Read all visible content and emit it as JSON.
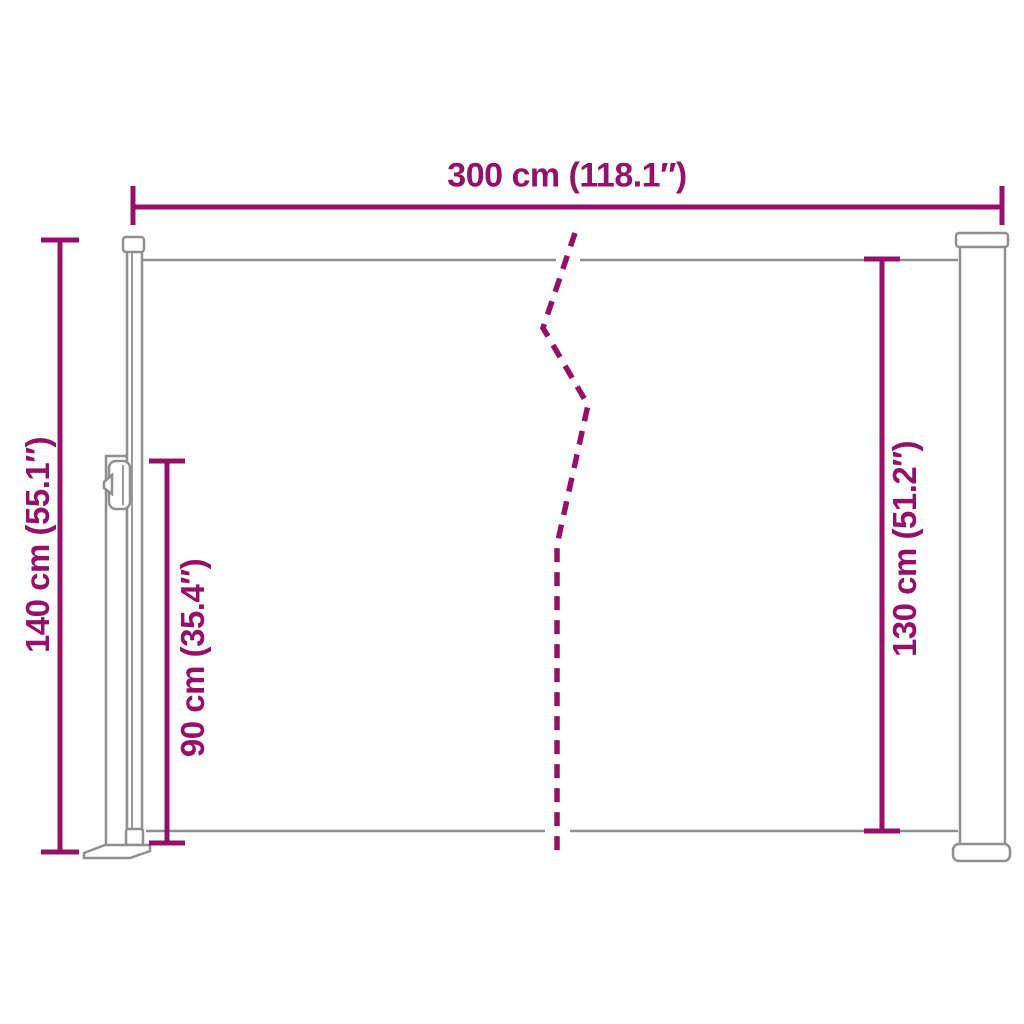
{
  "colors": {
    "accent": "#941069",
    "drawing_gray": "#8F8F8F",
    "background": "#FFFFFF"
  },
  "diagram": {
    "labels": {
      "top": "300 cm (118.1″)",
      "left": "140 cm (55.1″)",
      "inner": "90 cm (35.4″)",
      "right": "130 cm (51.2″)"
    }
  }
}
